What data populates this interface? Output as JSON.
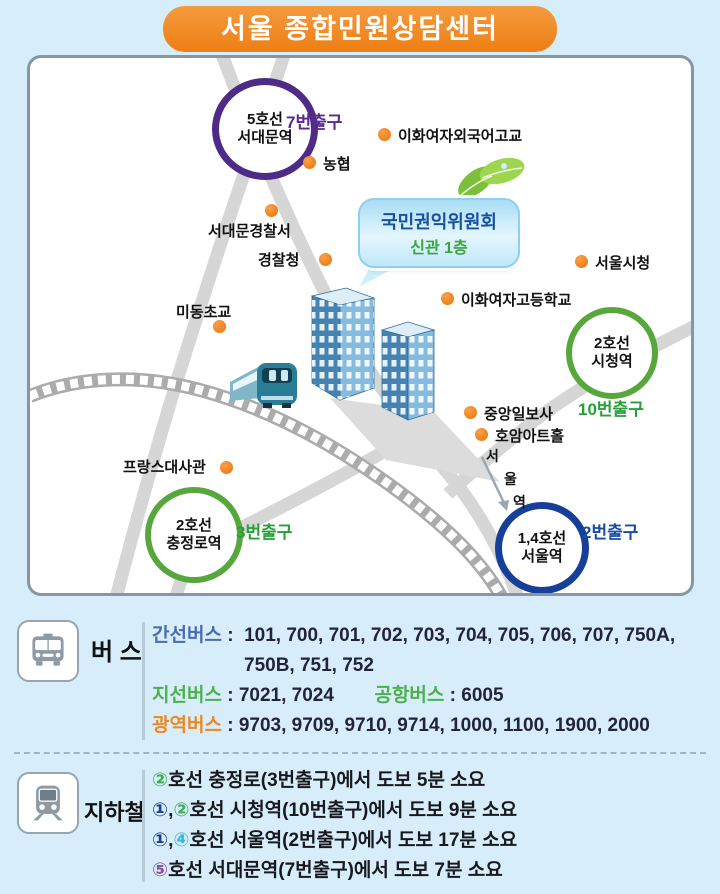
{
  "title": "서울 종합민원상담센터",
  "colors": {
    "banner_orange": "#ee7f15",
    "poi_dot_orange": "#e87408",
    "line5_purple": "#4e2b86",
    "line2_green": "#58a73c",
    "line14_navy": "#153f99",
    "exit_green": "#28a03a",
    "exit_purple": "#58298f",
    "exit_navy": "#1a4ba5",
    "trunk_blue": "#4a6ab4",
    "branch_green": "#4db04d",
    "metro_orange": "#f0861f",
    "badge_line1": "#1e3e95",
    "badge_line2": "#3fae4e",
    "badge_line4": "#33b8dc",
    "badge_line5": "#8d4b9e"
  },
  "map": {
    "bubble": {
      "line1": "국민권익위원회",
      "line2": "신관 1층"
    },
    "stations": {
      "seodaemun": {
        "line1": "5호선",
        "line2": "서대문역",
        "exit": "7번출구"
      },
      "sicheong": {
        "line1": "2호선",
        "line2": "시청역",
        "exit": "10번출구"
      },
      "chungjeongno": {
        "line1": "2호선",
        "line2": "충정로역",
        "exit": "3번출구"
      },
      "seoul": {
        "line1": "1,4호선",
        "line2": "서울역",
        "exit": "2번출구"
      }
    },
    "pois": {
      "ewha_foreign": "이화여자외국어고교",
      "nonghyup": "농협",
      "seodaemun_police": "서대문경찰서",
      "police_agency": "경찰청",
      "midong_elementary": "미동초교",
      "seoul_cityhall": "서울시청",
      "ewha_girls_high": "이화여자고등학교",
      "joongang_ilbo": "중앙일보사",
      "hoam_art_hall": "호암아트홀",
      "french_embassy": "프랑스대사관"
    },
    "seoul_station_vertical": {
      "c1": "서",
      "c2": "울",
      "c3": "역"
    }
  },
  "bus": {
    "section_label": "버 스",
    "colon": ":",
    "trunk_label": "간선버스",
    "trunk_values": "101, 700, 701, 702, 703, 704, 705, 706, 707, 750A,",
    "trunk_values2": "750B, 751, 752",
    "branch_label": "지선버스",
    "branch_values": "7021, 7024",
    "airport_label": "공항버스",
    "airport_values": "6005",
    "metro_label": "광역버스",
    "metro_values": "9703,  9709, 9710, 9714, 1000, 1100, 1900, 2000"
  },
  "subway": {
    "section_label": "지하철",
    "rows": [
      {
        "b1": "②",
        "rest": "호선 충정로(3번출구)에서 도보 5분 소요"
      },
      {
        "b1": "①",
        "comma": ",",
        "b2": "②",
        "rest": "호선 시청역(10번출구)에서 도보 9분 소요"
      },
      {
        "b1": "①",
        "comma": ",",
        "b2": "④",
        "rest": "호선 서울역(2번출구)에서 도보 17분 소요"
      },
      {
        "b1": "⑤",
        "rest": "호선 서대문역(7번출구)에서 도보 7분 소요"
      }
    ]
  }
}
